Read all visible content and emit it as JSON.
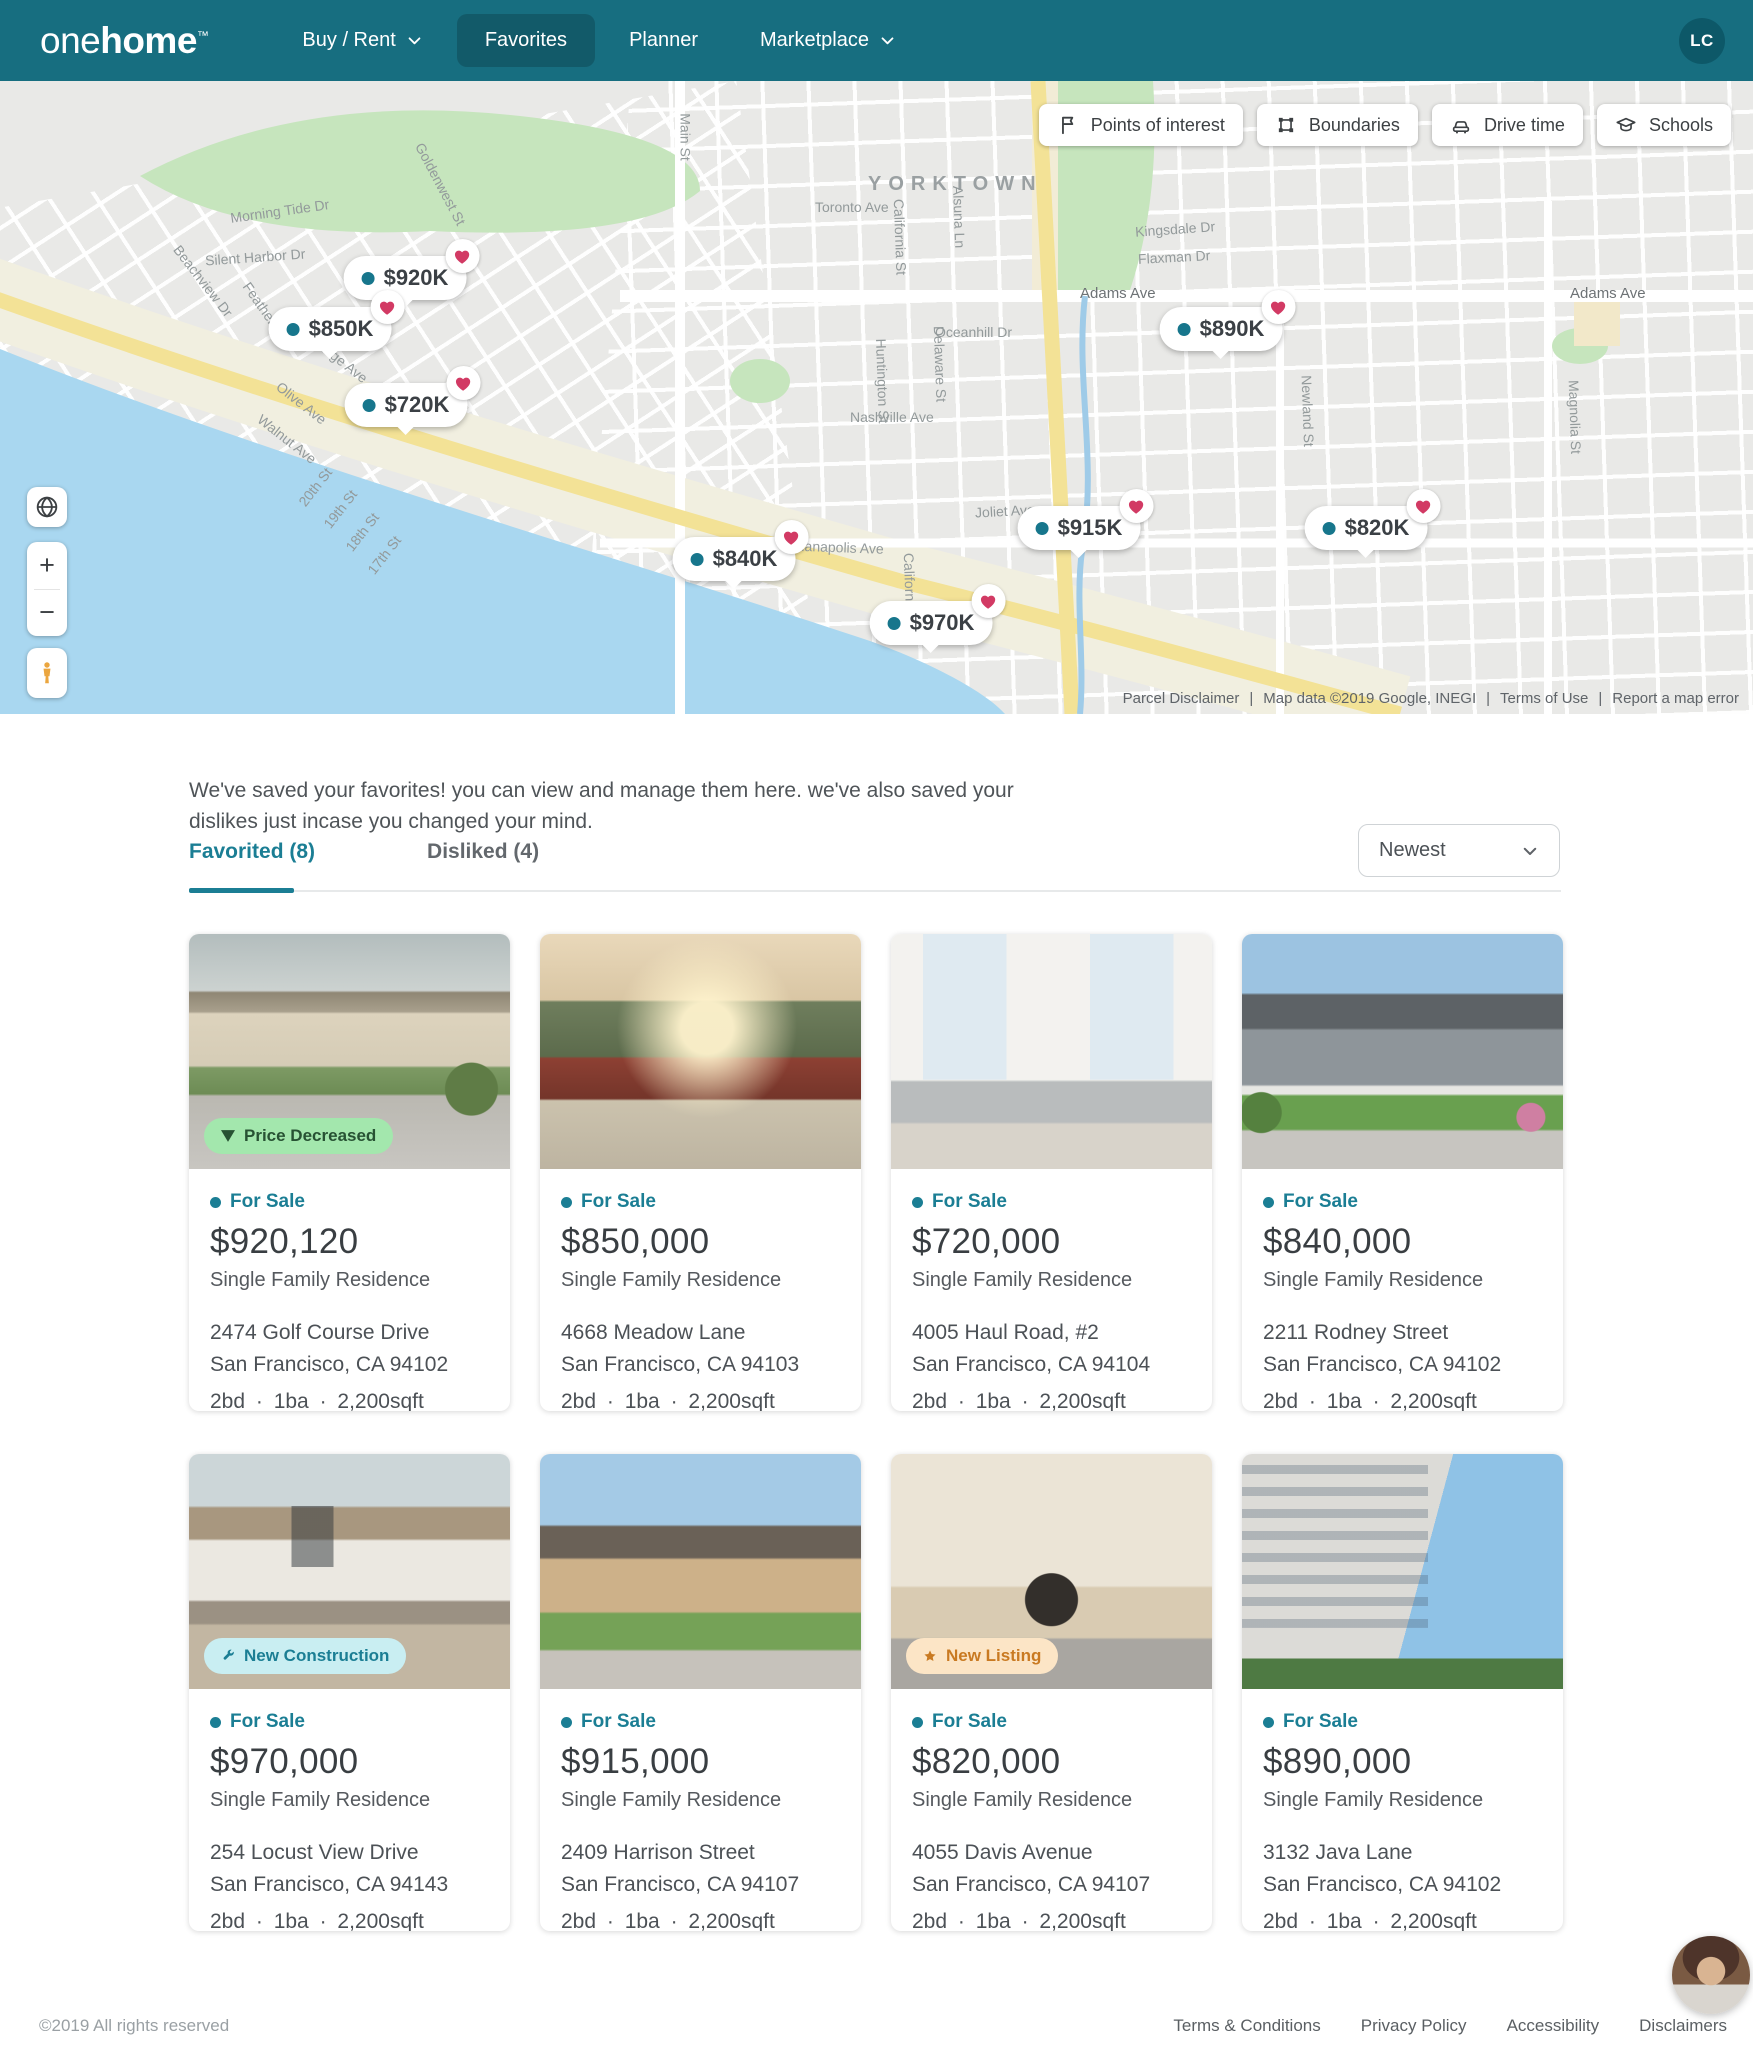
{
  "header": {
    "logo_one": "one",
    "logo_home": "home",
    "logo_tm": "™",
    "nav": [
      {
        "label": "Buy / Rent"
      },
      {
        "label": "Favorites"
      },
      {
        "label": "Planner"
      },
      {
        "label": "Marketplace"
      }
    ],
    "avatar_initials": "LC"
  },
  "map": {
    "region_label": "YORKTOWN",
    "tools": [
      {
        "label": "Points of interest"
      },
      {
        "label": "Boundaries"
      },
      {
        "label": "Drive time"
      },
      {
        "label": "Schools"
      }
    ],
    "pins": [
      {
        "price": "$920K"
      },
      {
        "price": "$850K"
      },
      {
        "price": "$720K"
      },
      {
        "price": "$890K"
      },
      {
        "price": "$915K"
      },
      {
        "price": "$840K"
      },
      {
        "price": "$970K"
      },
      {
        "price": "$820K"
      }
    ],
    "streets": [
      {
        "name": "Goldenwest St"
      },
      {
        "name": "Morning Tide Dr"
      },
      {
        "name": "Silent Harbor Dr"
      },
      {
        "name": "Beachview Dr"
      },
      {
        "name": "Feather Dr"
      },
      {
        "name": "Orange Ave"
      },
      {
        "name": "Olive Ave"
      },
      {
        "name": "Walnut Ave"
      },
      {
        "name": "20th St"
      },
      {
        "name": "19th St"
      },
      {
        "name": "18th St"
      },
      {
        "name": "17th St"
      },
      {
        "name": "Main St"
      },
      {
        "name": "Toronto Ave"
      },
      {
        "name": "California St"
      },
      {
        "name": "Alsuna Ln"
      },
      {
        "name": "Adams Ave"
      },
      {
        "name": "Adams Ave"
      },
      {
        "name": "Oceanhill Dr"
      },
      {
        "name": "Delaware St"
      },
      {
        "name": "Huntington St"
      },
      {
        "name": "Nashville Ave"
      },
      {
        "name": "Kingsdale Dr"
      },
      {
        "name": "Flaxman Dr"
      },
      {
        "name": "Joliet Ave"
      },
      {
        "name": "Indianapolis Ave"
      },
      {
        "name": "California St"
      },
      {
        "name": "Newland St"
      },
      {
        "name": "Magnolia St"
      }
    ],
    "zoom_in": "+",
    "zoom_out": "−",
    "attribution": {
      "items": [
        "Parcel Disclaimer",
        "Map data ©2019 Google, INEGI",
        "Terms of Use",
        "Report a map error"
      ],
      "sep": "|"
    }
  },
  "section": {
    "intro": "We've saved your favorites! you can view and manage them here. we've also saved your dislikes just incase you changed your mind.",
    "tabs": [
      {
        "label": "Favorited (8)"
      },
      {
        "label": "Disliked (4)"
      }
    ],
    "sort_value": "Newest"
  },
  "cards": [
    {
      "badge": {
        "label": "Price Decreased"
      },
      "status": "For Sale",
      "price": "$920,120",
      "type": "Single Family Residence",
      "address1": "2474  Golf Course Drive",
      "address2": "San Francisco, CA 94102",
      "specs": "2bd · 1ba · 2,200sqft",
      "match": "82%"
    },
    {
      "status": "For Sale",
      "price": "$850,000",
      "type": "Single Family Residence",
      "address1": "4668  Meadow Lane",
      "address2": "San Francisco, CA 94103",
      "specs": "2bd · 1ba · 2,200sqft",
      "match": "88%"
    },
    {
      "status": "For Sale",
      "price": "$720,000",
      "type": "Single Family Residence",
      "address1": "4005  Haul Road, #2",
      "address2": "San Francisco, CA 94104",
      "specs": "2bd · 1ba · 2,200sqft",
      "match": "79%"
    },
    {
      "status": "For Sale",
      "price": "$840,000",
      "type": "Single Family Residence",
      "address1": "2211  Rodney Street",
      "address2": "San Francisco, CA 94102",
      "specs": "2bd · 1ba · 2,200sqft",
      "match": "90%"
    },
    {
      "badge": {
        "label": "New Construction"
      },
      "status": "For Sale",
      "price": "$970,000",
      "type": "Single Family Residence",
      "address1": "254  Locust View Drive",
      "address2": "San Francisco, CA 94143",
      "specs": "2bd · 1ba · 2,200sqft",
      "match": "88%"
    },
    {
      "status": "For Sale",
      "price": "$915,000",
      "type": "Single Family Residence",
      "address1": "2409  Harrison Street",
      "address2": "San Francisco, CA 94107",
      "specs": "2bd · 1ba · 2,200sqft",
      "match": "76%"
    },
    {
      "badge": {
        "label": "New Listing"
      },
      "status": "For Sale",
      "price": "$820,000",
      "type": "Single Family Residence",
      "address1": "4055  Davis Avenue",
      "address2": "San Francisco, CA 94107",
      "specs": "2bd · 1ba · 2,200sqft",
      "match": "80%"
    },
    {
      "status": "For Sale",
      "price": "$890,000",
      "type": "Single Family Residence",
      "address1": "3132  Java Lane",
      "address2": "San Francisco, CA 94102",
      "specs": "2bd · 1ba · 2,200sqft",
      "match": "92%"
    }
  ],
  "footer": {
    "copyright": "©2019 All rights reserved",
    "links": [
      "Terms & Conditions",
      "Privacy Policy",
      "Accessibility",
      "Disclaimers"
    ]
  }
}
